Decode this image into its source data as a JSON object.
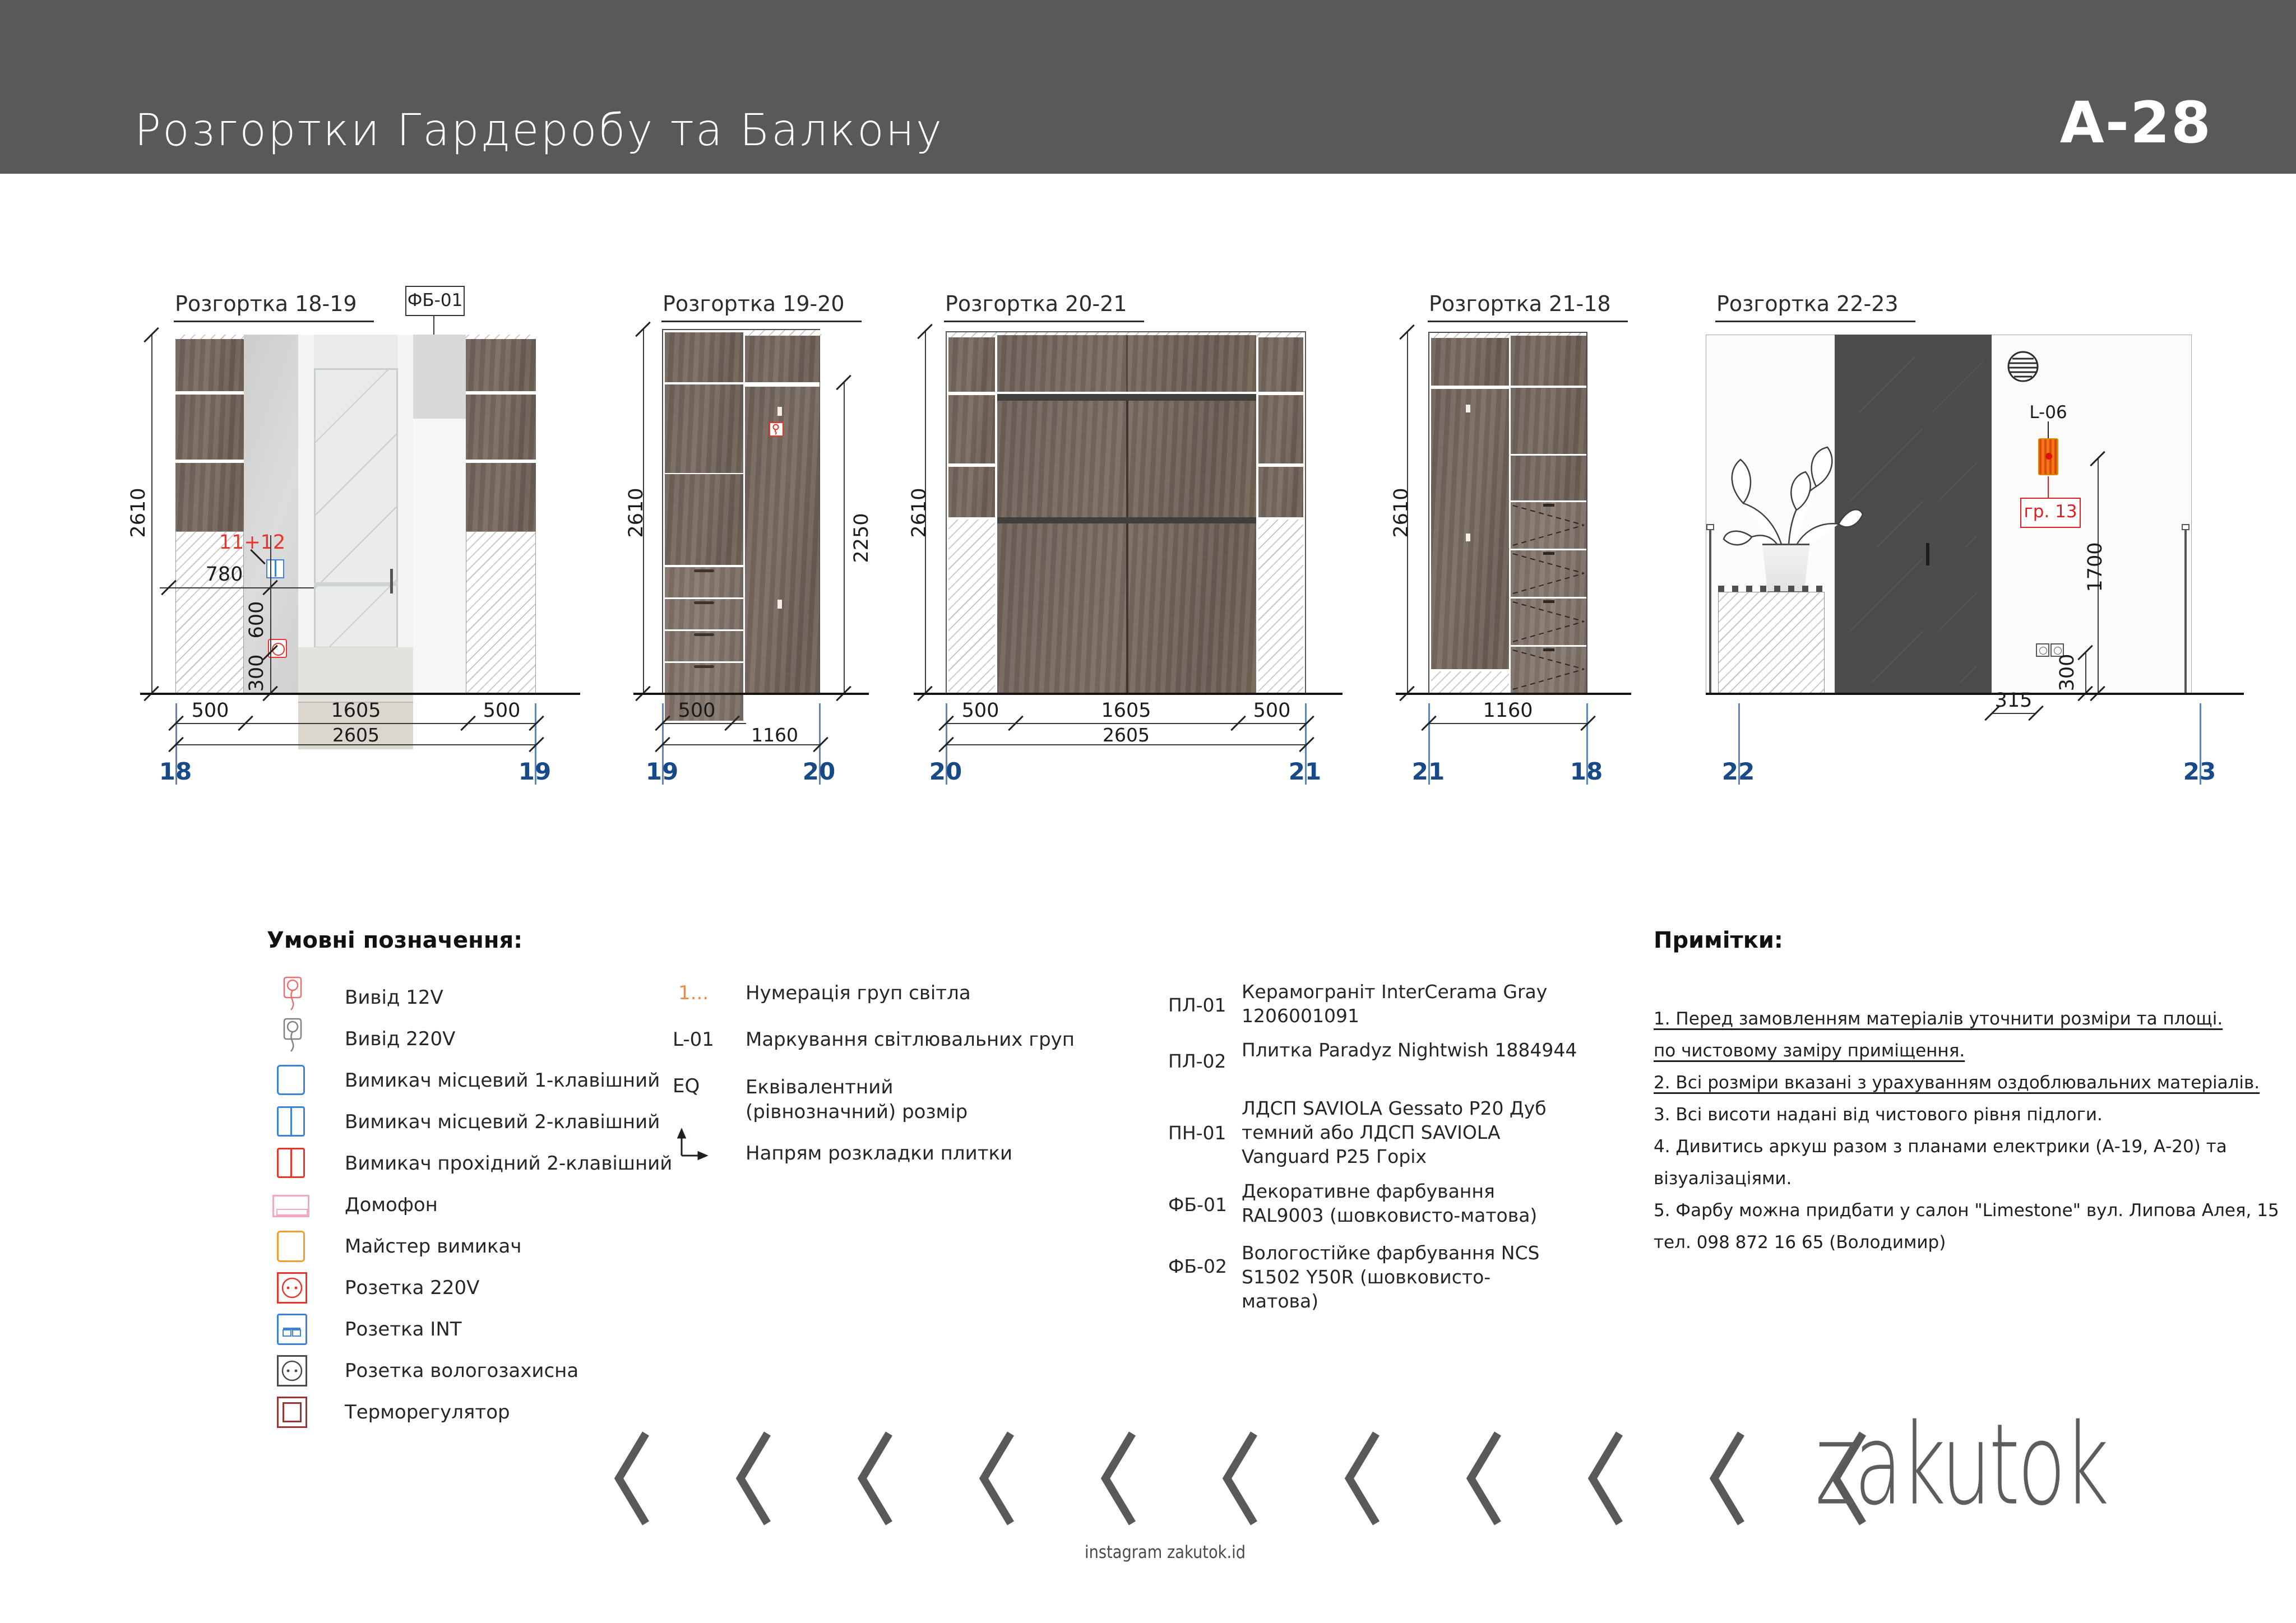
{
  "header": {
    "title": "Розгортки Гардеробу та Балкону",
    "sheet": "A-28"
  },
  "drawings": {
    "d1": {
      "label": "Розгортка 18-19",
      "tag": "ФБ-01",
      "height": "2610",
      "w780": "780",
      "w600": "600",
      "w300": "300",
      "group": "11+12",
      "r1": [
        "500",
        "1605",
        "500"
      ],
      "total": "2605",
      "ml": "18",
      "mr": "19"
    },
    "d2": {
      "label": "Розгортка 19-20",
      "height": "2610",
      "h2250": "2250",
      "r1": "500",
      "total": "1160",
      "ml": "19",
      "mr": "20"
    },
    "d3": {
      "label": "Розгортка 20-21",
      "height": "2610",
      "r1": [
        "500",
        "1605",
        "500"
      ],
      "total": "2605",
      "ml": "20",
      "mr": "21"
    },
    "d4": {
      "label": "Розгортка 21-18",
      "height": "2610",
      "total": "1160",
      "ml": "21",
      "mr": "18"
    },
    "d5": {
      "label": "Розгортка 22-23",
      "lamp": "L-06",
      "group": "гр. 13",
      "h1700": "1700",
      "h300": "300",
      "w315": "315",
      "ml": "22",
      "mr": "23"
    }
  },
  "legend": {
    "title": "Умовні позначення:",
    "items": [
      {
        "icon": "output-12v-icon",
        "label": "Вивід 12V"
      },
      {
        "icon": "output-220v-icon",
        "label": "Вивід 220V"
      },
      {
        "icon": "switch-local-1-icon",
        "label": "Вимикач місцевий 1-клавішний"
      },
      {
        "icon": "switch-local-2-icon",
        "label": "Вимикач місцевий 2-клавішний"
      },
      {
        "icon": "switch-pass-2-icon",
        "label": "Вимикач прохідний 2-клавішний"
      },
      {
        "icon": "intercom-icon",
        "label": "Домофон"
      },
      {
        "icon": "master-switch-icon",
        "label": "Майстер вимикач"
      },
      {
        "icon": "socket-220v-icon",
        "label": "Розетка 220V"
      },
      {
        "icon": "socket-int-icon",
        "label": "Розетка INT"
      },
      {
        "icon": "socket-waterproof-icon",
        "label": "Розетка вологозахисна"
      },
      {
        "icon": "thermostat-icon",
        "label": "Терморегулятор"
      }
    ]
  },
  "codes": {
    "items": [
      {
        "sym": "1...",
        "label": "Нумерація груп світла"
      },
      {
        "sym": "L-01",
        "label": "Маркування світлювальних груп"
      },
      {
        "sym": "EQ",
        "label": "Еквівалентний (рівнозначний) розмір"
      },
      {
        "sym": "",
        "label": "Напрям розкладки плитки"
      }
    ]
  },
  "materials": {
    "items": [
      {
        "code": "ПЛ-01",
        "desc": "Керамограніт InterCerama Gray 1206001091"
      },
      {
        "code": "ПЛ-02",
        "desc": "Плитка Paradyz Nightwish 1884944"
      },
      {
        "code": "ПН-01",
        "desc": "ЛДСП SAVIOLA Gessato P20 Дуб темний або ЛДСП SAVIOLA Vanguard P25 Горіх"
      },
      {
        "code": "ФБ-01",
        "desc": "Декоративне фарбування RAL9003 (шовковисто-матова)"
      },
      {
        "code": "ФБ-02",
        "desc": "Вологостійке фарбування NCS S1502 Y50R (шовковисто-матова)"
      }
    ]
  },
  "notes": {
    "title": "Примітки:",
    "lines": [
      "1. Перед замовленням матеріалів уточнити розміри та площі.",
      "по чистовому заміру приміщення.",
      "2. Всі розміри вказані з урахуванням оздоблювальних матеріалів.",
      "3. Всі висоти надані від чистового рівня підлоги.",
      "4. Дивитись аркуш разом з планами електрики (А-19, А-20) та",
      "візуалізаціями.",
      "5. Фарбу можна придбати у салон \"Limestone\" вул. Липова Алея, 15",
      "тел. 098 872 16 65 (Володимир)"
    ]
  },
  "footer": {
    "logo": "zakutok",
    "instagram": "instagram zakutok.id"
  }
}
